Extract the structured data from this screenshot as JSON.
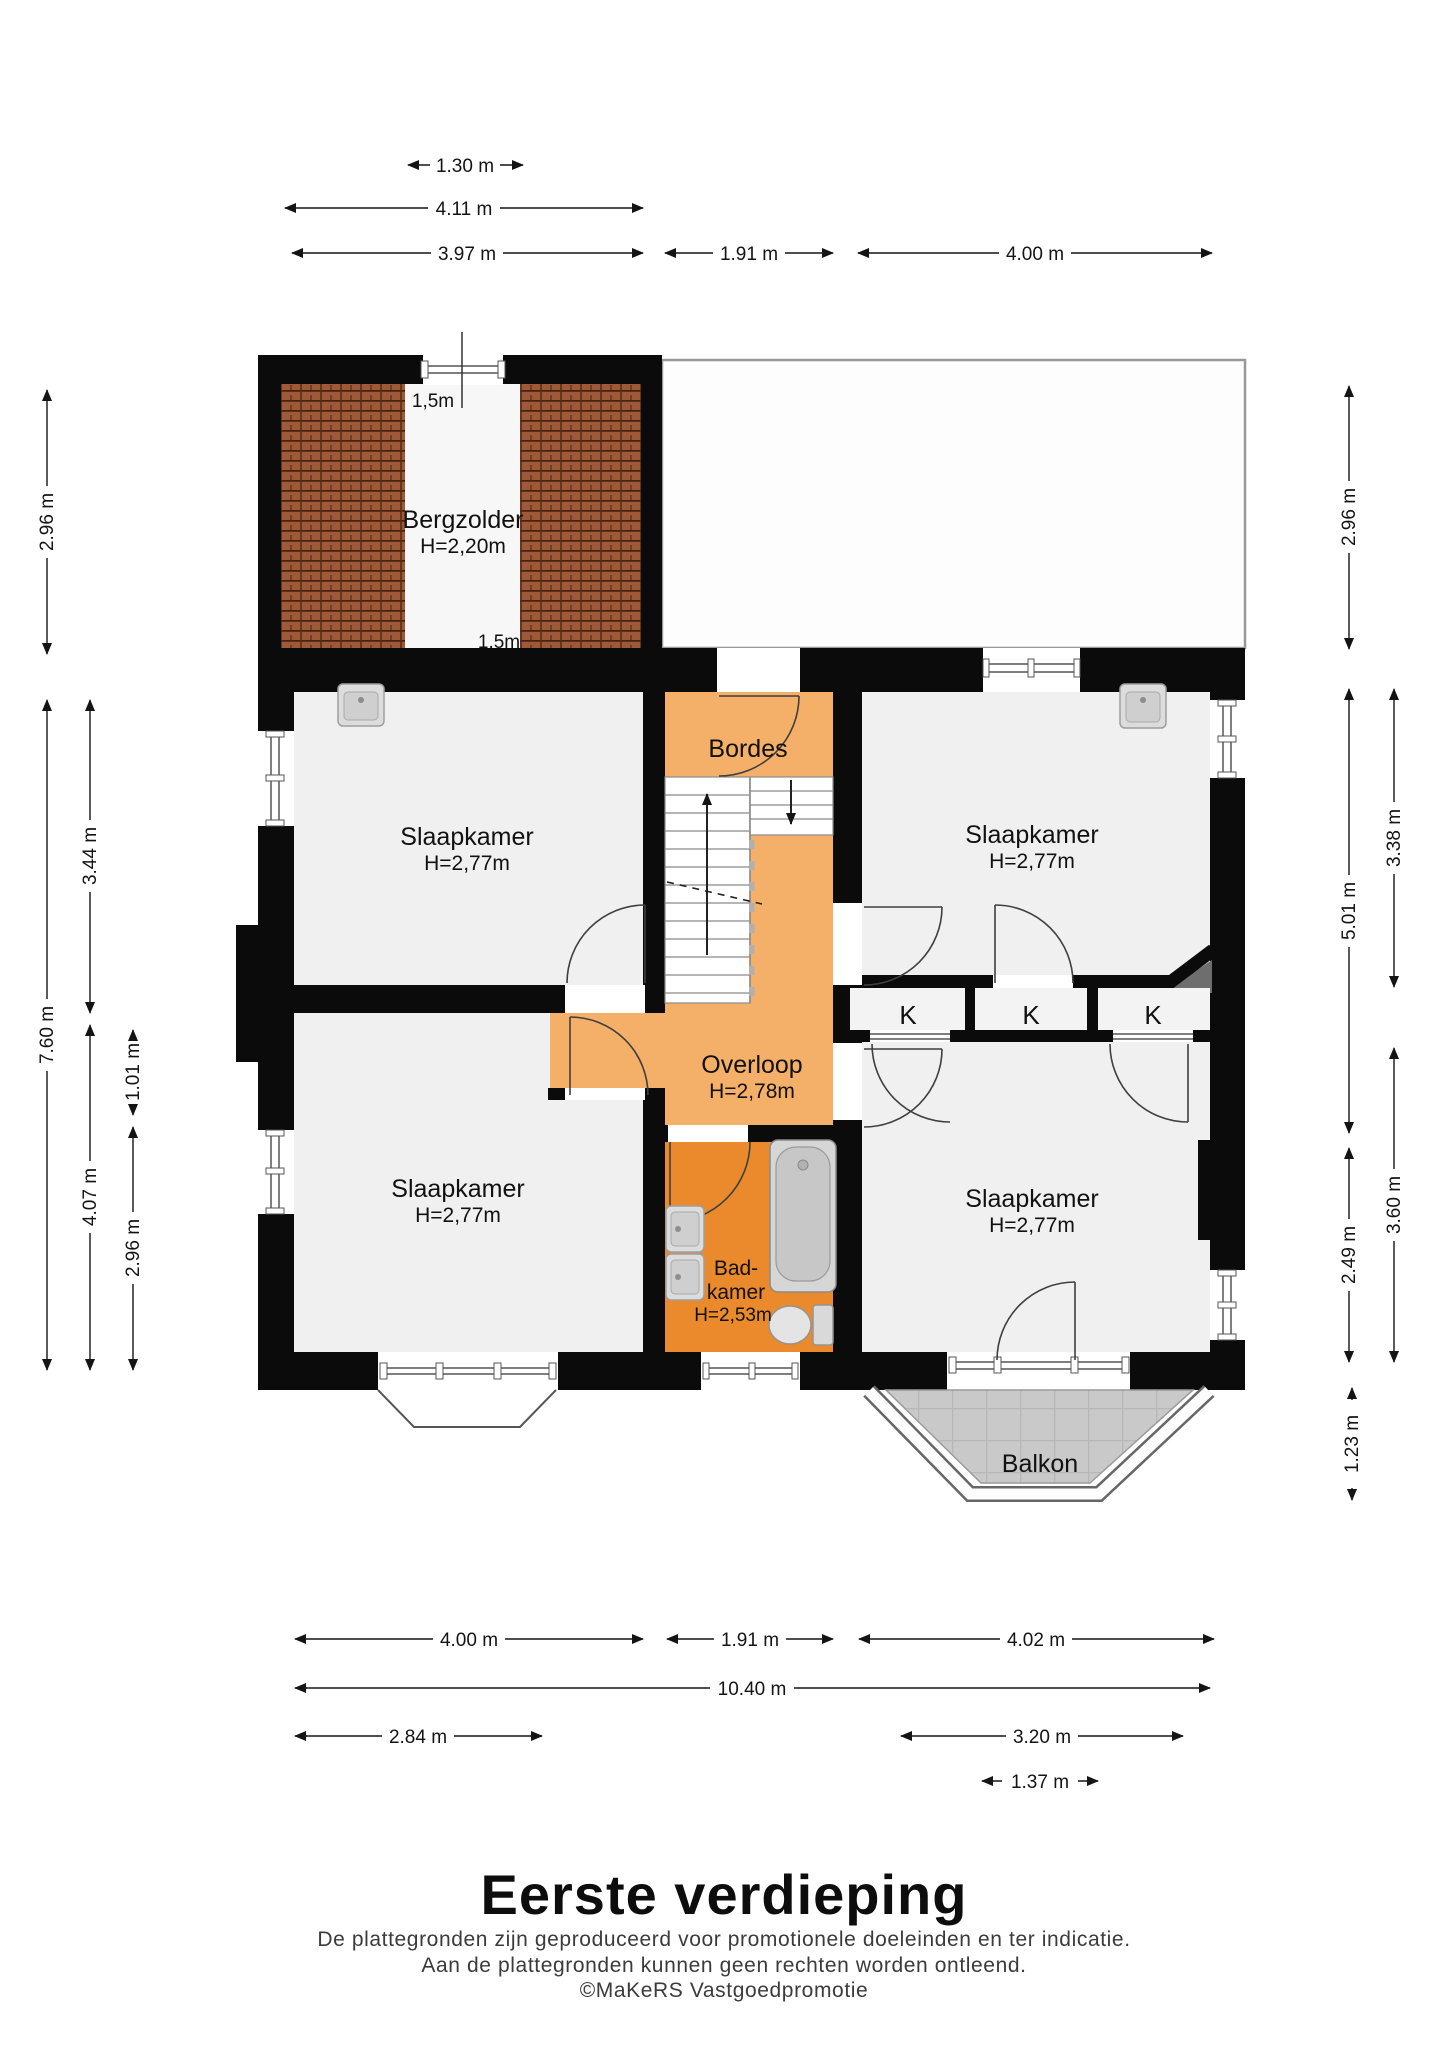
{
  "plan": {
    "bergzolder": {
      "name": "Bergzolder",
      "height": "H=2,20m",
      "clearance_top": "1,5m",
      "clearance_bottom": "1,5m"
    },
    "bordes": {
      "name": "Bordes"
    },
    "overloop": {
      "name": "Overloop",
      "height": "H=2,78m"
    },
    "badkamer": {
      "name_line1": "Bad-",
      "name_line2": "kamer",
      "height": "H=2,53m"
    },
    "slaapkamer": {
      "name": "Slaapkamer",
      "height": "H=2,77m"
    },
    "balkon": {
      "name": "Balkon"
    },
    "closet_label": "K"
  },
  "dimensions": {
    "top": [
      "1.30 m",
      "4.11 m",
      "3.97 m",
      "1.91 m",
      "4.00 m"
    ],
    "bottom": [
      "4.00 m",
      "1.91 m",
      "4.02 m",
      "10.40 m",
      "2.84 m",
      "3.20 m",
      "1.37 m"
    ],
    "left": [
      "2.96 m",
      "7.60 m",
      "3.44 m",
      "4.07 m",
      "1.01 m",
      "2.96 m"
    ],
    "right": [
      "2.96 m",
      "5.01 m",
      "2.49 m",
      "1.23 m",
      "3.38 m",
      "3.60 m"
    ]
  },
  "colors": {
    "walls": "#0b0b0b",
    "bedroom_fill": "#f0f0f0",
    "landing_orange": "#f4b069",
    "bathroom_orange": "#ea8a2c",
    "roof_tile_brown": "#9e5a38",
    "balcony_tile_gray": "#c9c9c9"
  },
  "footer": {
    "title": "Eerste verdieping",
    "disclaimer_line1": "De plattegronden zijn geproduceerd voor promotionele doeleinden en ter indicatie.",
    "disclaimer_line2": "Aan de plattegronden kunnen geen rechten worden ontleend.",
    "credit": "©MaKeRS Vastgoedpromotie"
  }
}
